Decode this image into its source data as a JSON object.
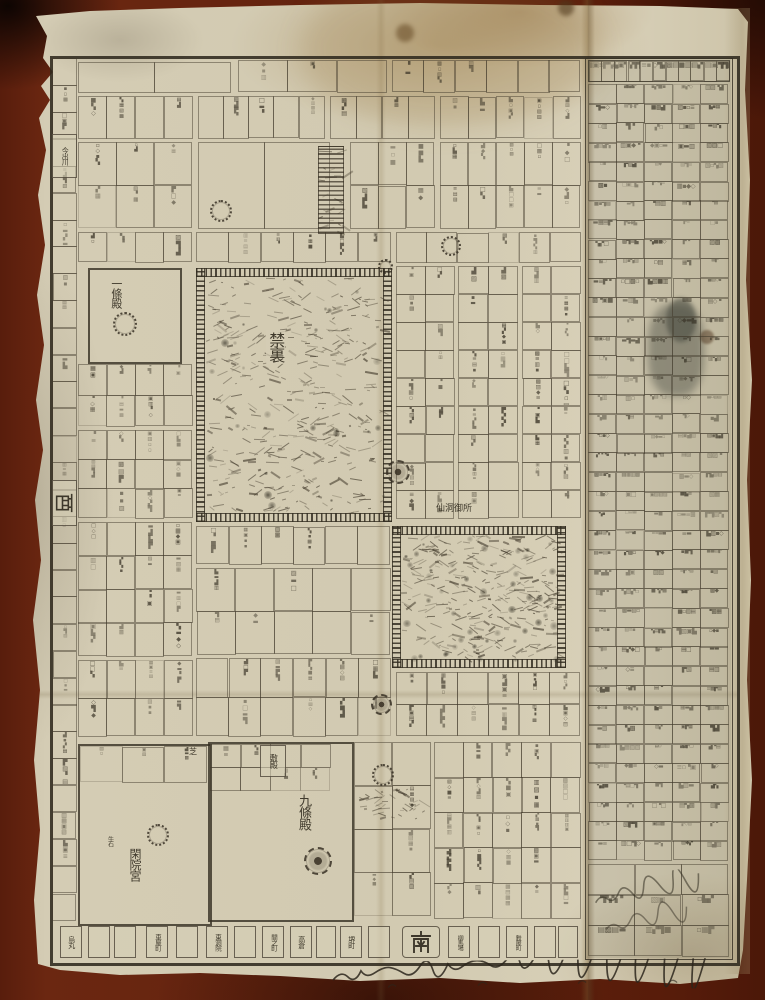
{
  "figure": {
    "kind": "photograph of an aged Edo-period woodblock-printed map of the Kyoto imperial palace district",
    "paper_color": "#d2cab1",
    "ink_color": "#3a342a",
    "background_color": "#5a1e0c"
  },
  "compass": {
    "south": "南",
    "west": "西"
  },
  "sites": {
    "kinri": "禁裏",
    "sento": "仙洞御所",
    "kujoden": "九條殿",
    "kaninnomiya": "閑院宮",
    "ichijoden": "一條殿",
    "shikiden": "敷殿",
    "shiba": "芝",
    "ushiishi": "牛石"
  },
  "streets": {
    "bottom": [
      "烏丸",
      "車屋町",
      "東洞院",
      "間之町",
      "高倉",
      "堺町",
      "柳馬場",
      "麩屋町"
    ],
    "left": [
      "今出川"
    ]
  },
  "directory_panel": {
    "legible": false,
    "description": "dense printed directory of court-noble residences along the right edge; characters too small and faded to read"
  },
  "handwriting": {
    "legible": false,
    "location": "cursive note along bottom margin below the map border"
  }
}
